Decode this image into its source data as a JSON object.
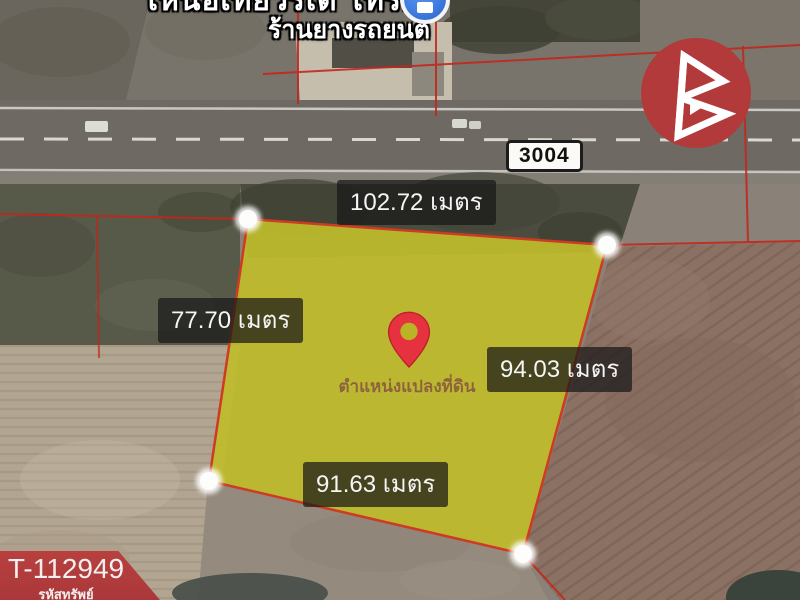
{
  "poi": {
    "name_line1": "เหนือเที่ยวรเด โทร...",
    "name_line2": "ร้านยางรถยนต์"
  },
  "road": {
    "route_number": "3004"
  },
  "plot": {
    "caption": "ตำแหน่งแปลงที่ดิน",
    "sides": {
      "top": "102.72 เมตร",
      "left": "77.70 เมตร",
      "right": "94.03 เมตร",
      "bottom": "91.63 เมตร"
    }
  },
  "property": {
    "code": "T-112949",
    "code_label": "รหัสทรัพย์"
  },
  "icons": {
    "pin": "map-pin",
    "poi_marker": "business-marker",
    "brand": "brand-logo-b",
    "corner_marker": "plot-corner-dot"
  },
  "colors": {
    "plot_fill": "#bfbc2b",
    "plot_border": "#cf3a22",
    "boundary_red": "#c4261c",
    "badge_red": "#b13c3e",
    "logo_red": "#b23a3b",
    "marker_blue": "#3e7de0",
    "pin_red": "#e5323e"
  }
}
